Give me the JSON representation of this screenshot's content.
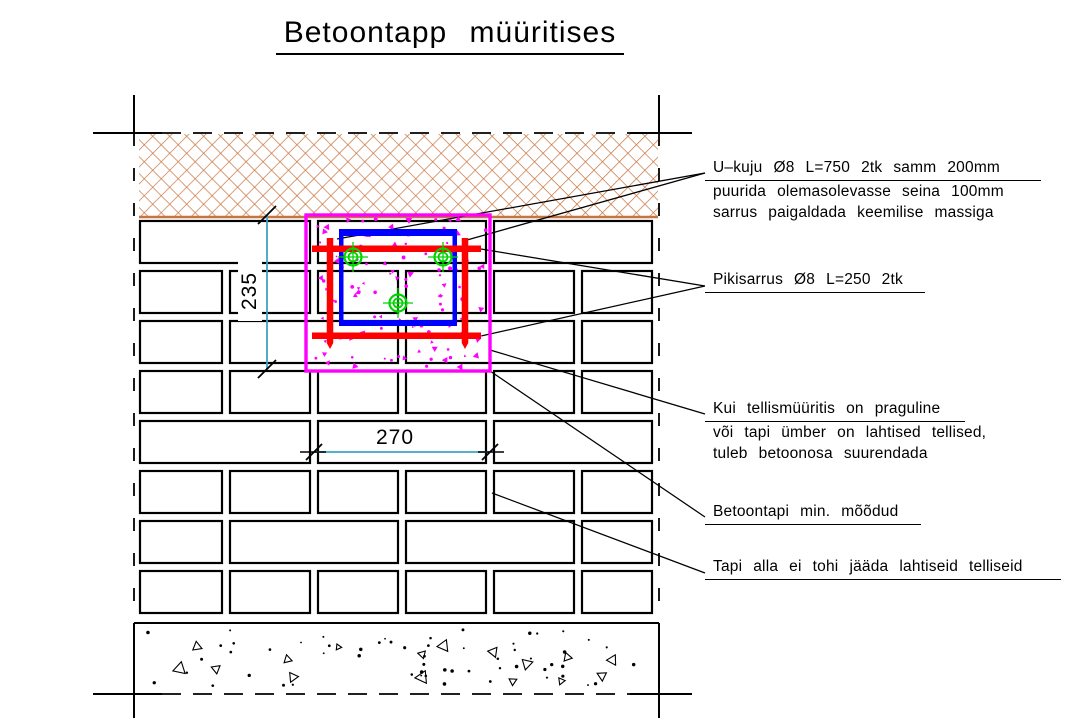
{
  "title": {
    "text": "Betoontapp müüritises"
  },
  "annotations": [
    {
      "lines": [
        "U–kuju Ø8 L=750 2tk samm 200mm",
        "puurida olemasolevasse seina 100mm",
        "sarrus paigaldada keemilise massiga"
      ]
    },
    {
      "lines": [
        "Pikisarrus Ø8 L=250 2tk"
      ]
    },
    {
      "lines": [
        "Kui tellismüüritis on praguline",
        "või tapi ümber on lahtised tellised,",
        "tuleb betoonosa suurendada"
      ]
    },
    {
      "lines": [
        "Betoontapi min. mõõdud"
      ]
    },
    {
      "lines": [
        "Tapi alla ei tohi jääda lahtiseid telliseid"
      ]
    }
  ],
  "dimensions": {
    "vertical": {
      "label": "235",
      "x": 267,
      "y1": 215,
      "y2": 369
    },
    "horizontal": {
      "label": "270",
      "y": 452,
      "x1": 314,
      "x2": 490
    }
  },
  "colors": {
    "hatch": "#c8743e",
    "concrete_outline": "#ff00ff",
    "u_bar": "#0000ff",
    "anchor_bar": "#ff0000",
    "bar_section": "#00d400",
    "dimension": "#3da4c4",
    "line": "#000000"
  },
  "drawing": {
    "canvas": {
      "w": 1071,
      "h": 722
    },
    "frame": {
      "vx": [
        134,
        659
      ],
      "post_top": 95,
      "post_bottom": 718,
      "hy": [
        133,
        694
      ],
      "tick_x1": 93,
      "tick_x2": 692,
      "solid_end_left": 162,
      "solid_start_right": 630,
      "vdash": "13 22",
      "hdash": "19 12"
    },
    "hatch": {
      "x": 139,
      "y": 134,
      "w": 519,
      "h": 83,
      "spacing": 12,
      "stroke_w": 1.4
    },
    "bricks": {
      "x_left": 140,
      "x_right": 652,
      "gap": 8,
      "row_h": 42,
      "stroke_w": 2.2,
      "rows": [
        {
          "y": 221,
          "joints": [
            314,
            490
          ]
        },
        {
          "y": 271,
          "joints": [
            226,
            314,
            402,
            490,
            578
          ]
        },
        {
          "y": 321,
          "joints": [
            226,
            402,
            578
          ]
        },
        {
          "y": 371,
          "joints": [
            226,
            314,
            402,
            490,
            578
          ]
        },
        {
          "y": 421,
          "joints": [
            314,
            490
          ]
        },
        {
          "y": 471,
          "joints": [
            226,
            314,
            402,
            490,
            578
          ]
        },
        {
          "y": 521,
          "joints": [
            226,
            402,
            578
          ]
        },
        {
          "y": 571,
          "joints": [
            226,
            314,
            402,
            490,
            578
          ]
        }
      ]
    },
    "footing": {
      "x": 134,
      "y": 623,
      "w": 525,
      "h": 71,
      "dots": 58,
      "triangles": 16
    },
    "tap_box": {
      "x": 306,
      "y": 215,
      "w": 184,
      "h": 156,
      "stroke_w": 3.4,
      "speckles": 120
    },
    "u_bar": {
      "x1": 339,
      "x2": 457,
      "y1": 229,
      "y2": 326,
      "top_t": 7,
      "bot_t": 6,
      "side_t": 4.5
    },
    "anchor": {
      "h_y": [
        245.5,
        332.5
      ],
      "h_x1": 312,
      "h_x2": 481,
      "h_t": 6.5,
      "v_x": [
        330,
        465
      ],
      "v_y1": 238,
      "v_y2": 343,
      "v_t": 6.5,
      "tip": 6
    },
    "bar_sections": {
      "points": [
        [
          353,
          257
        ],
        [
          443,
          257
        ],
        [
          398,
          303
        ]
      ],
      "r_outer": 8.5,
      "r_inner": 4.5,
      "cross": 15
    },
    "leaders": [
      [
        [
          337,
          239
        ],
        [
          705,
          173
        ]
      ],
      [
        [
          467,
          240
        ],
        [
          705,
          173
        ]
      ],
      [
        [
          481,
          249
        ],
        [
          705,
          286
        ]
      ],
      [
        [
          481,
          336
        ],
        [
          705,
          286
        ]
      ],
      [
        [
          490,
          350
        ],
        [
          705,
          414
        ]
      ],
      [
        [
          490,
          371
        ],
        [
          705,
          517
        ]
      ],
      [
        [
          492,
          493
        ],
        [
          705,
          573
        ]
      ]
    ]
  }
}
